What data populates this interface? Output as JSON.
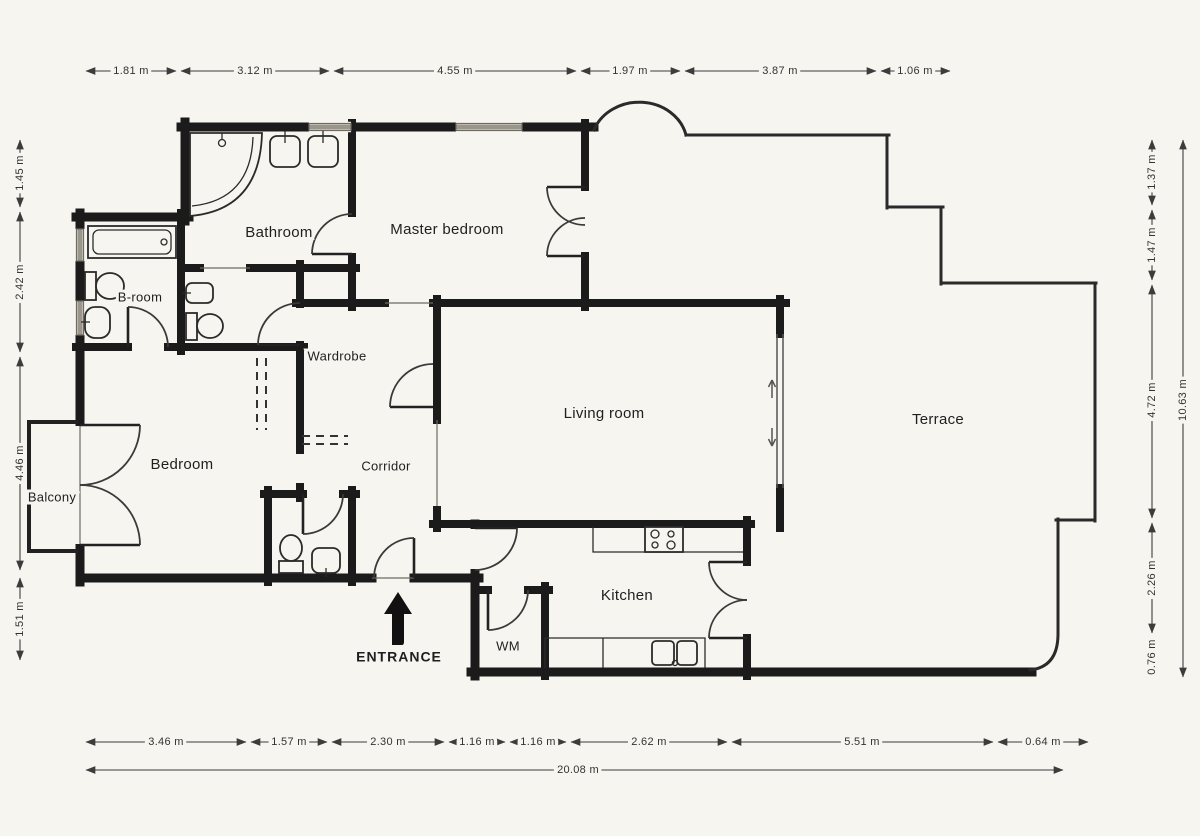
{
  "rooms": {
    "bathroom": "Bathroom",
    "master_bedroom": "Master bedroom",
    "b_room": "B-room",
    "wardrobe": "Wardrobe",
    "living_room": "Living room",
    "terrace": "Terrace",
    "bedroom": "Bedroom",
    "corridor": "Corridor",
    "balcony": "Balcony",
    "kitchen": "Kitchen",
    "wm": "WM"
  },
  "entrance": {
    "label": "ENTRANCE"
  },
  "dimensions": {
    "top": [
      "1.81 m",
      "3.12 m",
      "4.55 m",
      "1.97 m",
      "3.87 m",
      "1.06 m"
    ],
    "left": [
      "1.45 m",
      "2.42 m",
      "4.46 m",
      "1.51 m"
    ],
    "right": [
      "1.37 m",
      "1.47 m",
      "4.72 m",
      "2.26 m",
      "0.76 m"
    ],
    "right_total": "10.63 m",
    "bottom": [
      "3.46 m",
      "1.57 m",
      "2.30 m",
      "1.16 m",
      "1.16 m",
      "2.62 m",
      "5.51 m",
      "0.64 m"
    ],
    "bottom_total": "20.08 m"
  },
  "colors": {
    "wall": "#1b1b1b",
    "thin_line": "#2a2a2a",
    "dimension_line": "#3c3c3c",
    "window": "#9b968c",
    "background": "#f7f5ef",
    "text": "#1f1f1f"
  }
}
